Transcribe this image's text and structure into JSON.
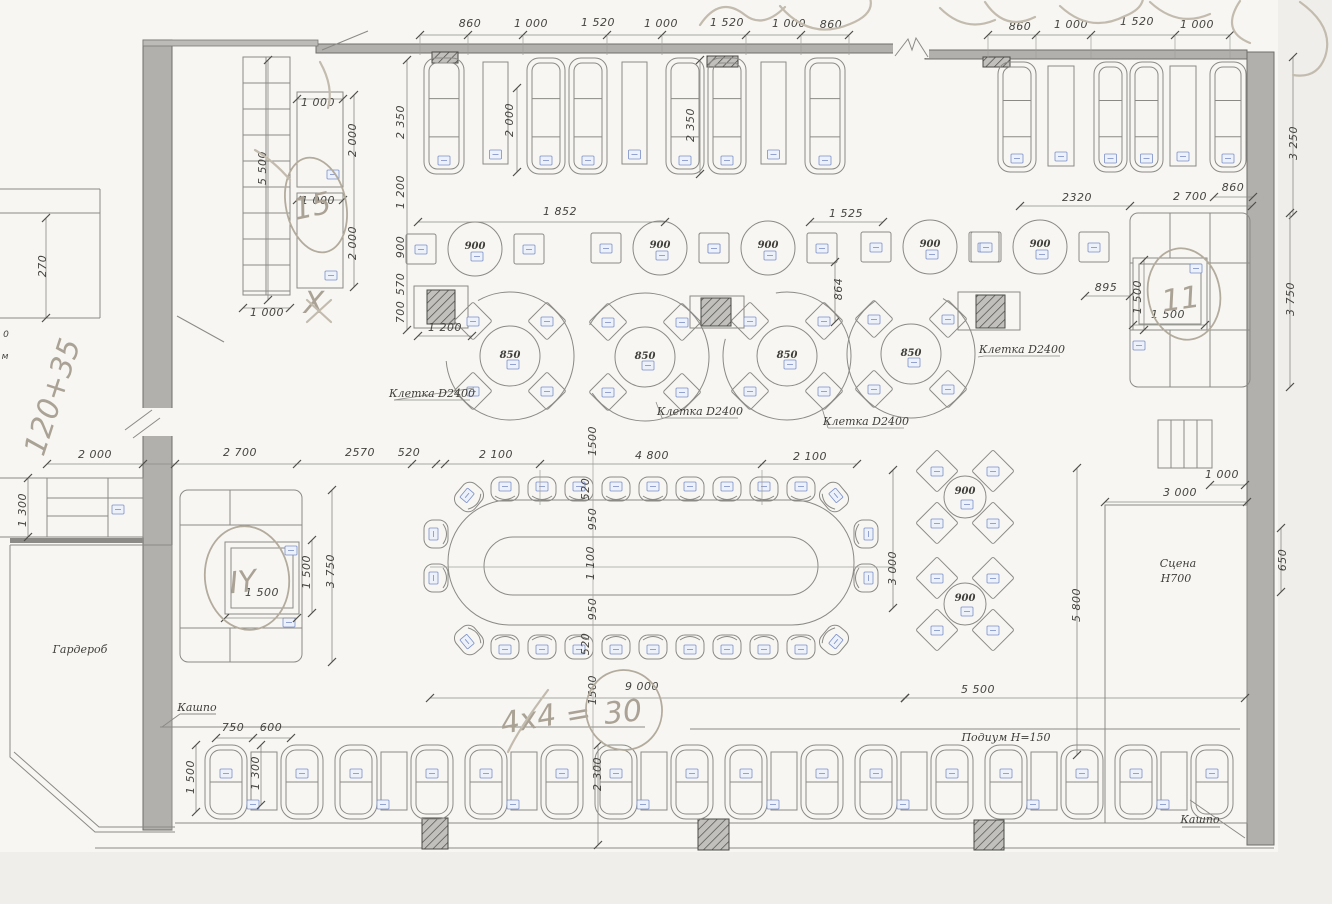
{
  "colors": {
    "paper": "#f7f6f3",
    "wall_fill": "#b2b0ad",
    "ink_line": "#8b8a85",
    "dim_text": "#45443f",
    "pencil": "#b3ab9c",
    "blue_tag": "#7b8fc7"
  },
  "furniture_labels": {
    "round_table_large": "850",
    "round_table_small": "900"
  },
  "cage_labels": [
    {
      "t": "Клетка D2400",
      "x": 432,
      "y": 397
    },
    {
      "t": "Клетка D2400",
      "x": 700,
      "y": 415
    },
    {
      "t": "Клетка D2400",
      "x": 866,
      "y": 425
    },
    {
      "t": "Клетка D2400",
      "x": 1022,
      "y": 353
    }
  ],
  "labels": [
    {
      "t": "Гардероб",
      "x": 80,
      "y": 653,
      "s": 12
    },
    {
      "t": "Сцена",
      "x": 1178,
      "y": 567,
      "s": 11
    },
    {
      "t": "Н700",
      "x": 1176,
      "y": 582,
      "s": 11
    },
    {
      "t": "Подиум Н=150",
      "x": 1006,
      "y": 741,
      "s": 10
    },
    {
      "t": "Кашпо",
      "x": 197,
      "y": 711,
      "s": 9
    },
    {
      "t": "Кашпо",
      "x": 1200,
      "y": 823,
      "s": 9
    }
  ],
  "dimensions": [
    {
      "t": "860",
      "x": 470,
      "y": 27
    },
    {
      "t": "1 000",
      "x": 531,
      "y": 27
    },
    {
      "t": "1 520",
      "x": 598,
      "y": 26
    },
    {
      "t": "1 000",
      "x": 661,
      "y": 27
    },
    {
      "t": "1 520",
      "x": 727,
      "y": 26
    },
    {
      "t": "1 000",
      "x": 789,
      "y": 27
    },
    {
      "t": "860",
      "x": 831,
      "y": 28
    },
    {
      "t": "860",
      "x": 1020,
      "y": 30
    },
    {
      "t": "1 000",
      "x": 1071,
      "y": 28
    },
    {
      "t": "1 520",
      "x": 1137,
      "y": 25
    },
    {
      "t": "1 000",
      "x": 1197,
      "y": 28
    },
    {
      "t": "1 000",
      "x": 318,
      "y": 106
    },
    {
      "t": "2 000",
      "x": 356,
      "y": 140,
      "r": -90
    },
    {
      "t": "1 000",
      "x": 318,
      "y": 204
    },
    {
      "t": "2 000",
      "x": 356,
      "y": 243,
      "r": -90
    },
    {
      "t": "5 500",
      "x": 266,
      "y": 168,
      "r": -90
    },
    {
      "t": "1 000",
      "x": 267,
      "y": 316
    },
    {
      "t": "2 350",
      "x": 404,
      "y": 122,
      "r": -90
    },
    {
      "t": "2 000",
      "x": 513,
      "y": 120,
      "r": -90
    },
    {
      "t": "2 350",
      "x": 694,
      "y": 125,
      "r": -90
    },
    {
      "t": "1 200",
      "x": 404,
      "y": 192,
      "r": -90
    },
    {
      "t": "900",
      "x": 404,
      "y": 247,
      "r": -90
    },
    {
      "t": "570",
      "x": 404,
      "y": 284,
      "r": -90
    },
    {
      "t": "700",
      "x": 404,
      "y": 312,
      "r": -90
    },
    {
      "t": "1 200",
      "x": 445,
      "y": 331
    },
    {
      "t": "2320",
      "x": 1077,
      "y": 201
    },
    {
      "t": "2 700",
      "x": 1190,
      "y": 200
    },
    {
      "t": "860",
      "x": 1233,
      "y": 191
    },
    {
      "t": "3 250",
      "x": 1297,
      "y": 143,
      "r": -90
    },
    {
      "t": "895",
      "x": 1106,
      "y": 291
    },
    {
      "t": "1 500",
      "x": 1141,
      "y": 297,
      "r": -90
    },
    {
      "t": "1 500",
      "x": 1168,
      "y": 318
    },
    {
      "t": "3 750",
      "x": 1294,
      "y": 299,
      "r": -90
    },
    {
      "t": "1 852",
      "x": 560,
      "y": 215
    },
    {
      "t": "1 525",
      "x": 846,
      "y": 217
    },
    {
      "t": "864",
      "x": 842,
      "y": 289,
      "r": -90
    },
    {
      "t": "2 000",
      "x": 95,
      "y": 458
    },
    {
      "t": "2 700",
      "x": 240,
      "y": 456
    },
    {
      "t": "2570",
      "x": 360,
      "y": 456
    },
    {
      "t": "520",
      "x": 409,
      "y": 456
    },
    {
      "t": "2 100",
      "x": 496,
      "y": 458
    },
    {
      "t": "4 800",
      "x": 652,
      "y": 459
    },
    {
      "t": "2 100",
      "x": 810,
      "y": 460
    },
    {
      "t": "1 300",
      "x": 26,
      "y": 510,
      "r": -90
    },
    {
      "t": "1 500",
      "x": 310,
      "y": 572,
      "r": -90
    },
    {
      "t": "3 750",
      "x": 334,
      "y": 571,
      "r": -90
    },
    {
      "t": "1 500",
      "x": 262,
      "y": 596
    },
    {
      "t": "1500",
      "x": 596,
      "y": 441,
      "r": -90
    },
    {
      "t": "520",
      "x": 589,
      "y": 489,
      "r": -90
    },
    {
      "t": "950",
      "x": 596,
      "y": 519,
      "r": -90
    },
    {
      "t": "1 100",
      "x": 594,
      "y": 563,
      "r": -90
    },
    {
      "t": "950",
      "x": 596,
      "y": 609,
      "r": -90
    },
    {
      "t": "520",
      "x": 589,
      "y": 644,
      "r": -90
    },
    {
      "t": "1500",
      "x": 596,
      "y": 690,
      "r": -90
    },
    {
      "t": "3 000",
      "x": 896,
      "y": 568,
      "r": -90
    },
    {
      "t": "9 000",
      "x": 642,
      "y": 690
    },
    {
      "t": "5 500",
      "x": 978,
      "y": 693
    },
    {
      "t": "5 800",
      "x": 1080,
      "y": 605,
      "r": -90
    },
    {
      "t": "1 000",
      "x": 1222,
      "y": 478
    },
    {
      "t": "3 000",
      "x": 1180,
      "y": 496
    },
    {
      "t": "650",
      "x": 1286,
      "y": 560,
      "r": -90
    },
    {
      "t": "750",
      "x": 233,
      "y": 731
    },
    {
      "t": "600",
      "x": 271,
      "y": 731
    },
    {
      "t": "1 500",
      "x": 194,
      "y": 777,
      "r": -90
    },
    {
      "t": "1 300",
      "x": 259,
      "y": 773,
      "r": -90
    },
    {
      "t": "2 300",
      "x": 601,
      "y": 774,
      "r": -90
    },
    {
      "t": "270",
      "x": 46,
      "y": 266,
      "r": -90
    },
    {
      "t": "0",
      "x": 6,
      "y": 337
    },
    {
      "t": "м",
      "x": 5,
      "y": 359
    }
  ],
  "handwriting": [
    {
      "t": "120+35",
      "x": 62,
      "y": 400,
      "r": -72,
      "s": 30
    },
    {
      "t": "15",
      "x": 314,
      "y": 216,
      "r": -12,
      "s": 34
    },
    {
      "t": "Х",
      "x": 314,
      "y": 313,
      "r": 0,
      "s": 20
    },
    {
      "t": "IY",
      "x": 244,
      "y": 592,
      "r": -6,
      "s": 36
    },
    {
      "t": "11",
      "x": 1182,
      "y": 309,
      "r": -8,
      "s": 40
    },
    {
      "t": "4х4",
      "x": 530,
      "y": 729,
      "r": -10,
      "s": 34
    },
    {
      "t": "=",
      "x": 580,
      "y": 724,
      "r": -10,
      "s": 30
    },
    {
      "t": "30",
      "x": 624,
      "y": 722,
      "r": -6,
      "s": 34
    }
  ]
}
